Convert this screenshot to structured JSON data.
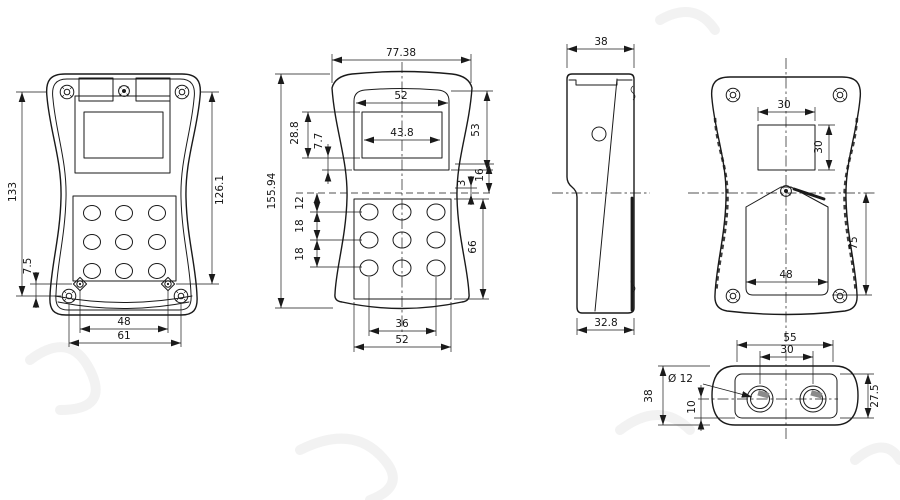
{
  "drawing": {
    "kind": "enclosure-dimension-drawing",
    "colors": {
      "background": "#ffffff",
      "line": "#1a1a1a",
      "shading": "#8b8b8b",
      "watermark": "#cfcfcf"
    }
  },
  "views": {
    "front": {
      "dims": {
        "height_overall": "133",
        "height_to_boss": "126.1",
        "boss_offset": "7.5",
        "boss_span": "48",
        "base_width": "61"
      }
    },
    "front_dim": {
      "dims": {
        "width_top": "77.38",
        "bezel_width": "52",
        "lcd_width": "43.8",
        "lcd_height": "28.8",
        "lcd_to_bezel": "7.7",
        "bezel_height": "53",
        "height_overall": "155.94",
        "waist_gap": "3",
        "waist_to_keypad": "16",
        "row_offset": "12",
        "row_pitch_1": "18",
        "row_pitch_2": "18",
        "keypad_height": "66",
        "button_span": "36",
        "keypad_width": "52"
      }
    },
    "side": {
      "dims": {
        "depth_top": "38",
        "depth_bottom": "32.8"
      }
    },
    "back": {
      "dims": {
        "window_width": "30",
        "window_height": "30",
        "door_height": "75",
        "door_width": "48"
      }
    },
    "bottom": {
      "dims": {
        "end_span": "55",
        "gland_pitch": "30",
        "gland_dia": "Ø 12",
        "depth": "38",
        "gland_offset": "10",
        "face_depth": "27.5"
      }
    }
  }
}
